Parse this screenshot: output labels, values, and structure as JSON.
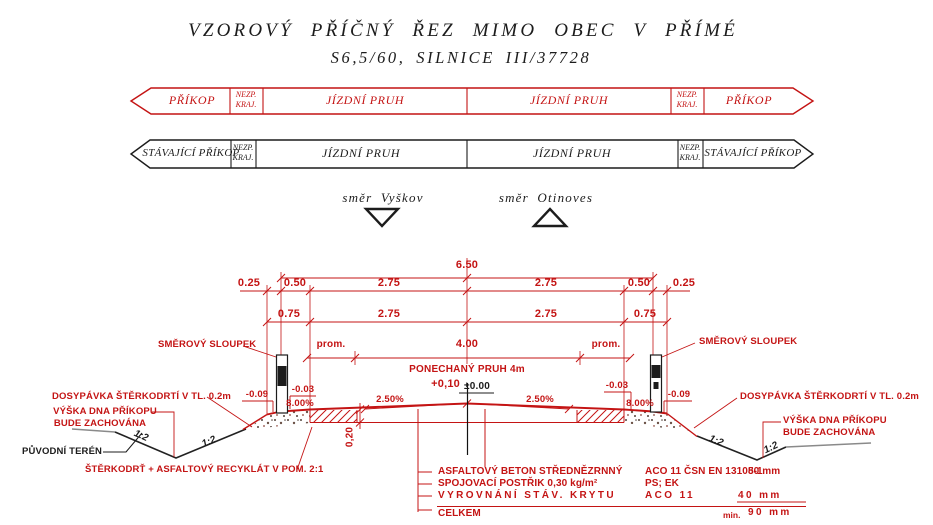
{
  "title": {
    "line1": "VZOROVÝ PŘÍČNÝ ŘEZ MIMO OBEC V PŘÍMÉ",
    "line2": "S6,5/60, SILNICE III/37728"
  },
  "band_proposed": {
    "ditch_left": "PŘÍKOP",
    "shoulder_top": "NEZP.",
    "shoulder_bottom": "KRAJ.",
    "lane_left": "JÍZDNÍ PRUH",
    "lane_right": "JÍZDNÍ PRUH",
    "ditch_right": "PŘÍKOP"
  },
  "band_existing": {
    "ditch_left": "STÁVAJÍCÍ PŘÍKOP",
    "shoulder_top": "NEZP.",
    "shoulder_bottom": "KRAJ.",
    "lane_left": "JÍZDNÍ PRUH",
    "lane_right": "JÍZDNÍ PRUH",
    "ditch_right": "STÁVAJÍCÍ PŘÍKOP"
  },
  "directions": {
    "left": "směr Vyškov",
    "right": "směr Otinoves"
  },
  "dims": {
    "total": "6.50",
    "row2": [
      "0.25",
      "0.50",
      "2.75",
      "2.75",
      "0.50",
      "0.25"
    ],
    "row3": [
      "0.75",
      "2.75",
      "2.75",
      "0.75"
    ],
    "row4": [
      "prom.",
      "4.00",
      "prom."
    ],
    "kept_lane": "PONECHANÝ PRUH 4m",
    "pavement_depth": "0,20"
  },
  "levels": {
    "new_center": "+0,10",
    "existing_center": "±0.00",
    "left_outer": "-0.09",
    "left_edge": "-0.03",
    "right_edge": "-0.03",
    "right_outer": "-0.09"
  },
  "slopes": {
    "cross_left": "2.50%",
    "cross_right": "2.50%",
    "shoulder_left": "8.00%",
    "shoulder_right": "8.00%",
    "embankment": "1:2"
  },
  "labels": {
    "guide_post": "SMĚROVÝ SLOUPEK",
    "gravel_backfill": "DOSYPÁVKA ŠTĚRKODRTÍ V TL. 0.2m",
    "ditch_line1": "VÝŠKA DNA PŘÍKOPU",
    "ditch_line2": "BUDE ZACHOVÁNA",
    "original_terrain": "PŮVODNÍ TERÉN",
    "recycled_fill": "ŠTĚRKODRŤ + ASFALTOVÝ RECYKLÁT V POM. 2:1"
  },
  "layers": {
    "rows": [
      {
        "name": "ASFALTOVÝ BETON STŘEDNĚZRNNÝ",
        "spec": "ACO 11 ČSN EN 13108-1",
        "thickness": "50 mm"
      },
      {
        "name": "SPOJOVACÍ POSTŘIK 0,30 kg/m²",
        "spec": "PS; EK",
        "thickness": ""
      },
      {
        "name": "VYROVNÁNÍ STÁV. KRYTU",
        "spec": "ACO 11",
        "thickness": "40 mm"
      }
    ],
    "total": {
      "label": "CELKEM",
      "prefix": "min.",
      "value": "90 mm"
    }
  },
  "colors": {
    "red": "#c41414",
    "black": "#1c1c1c",
    "gray": "#8a8a8a"
  }
}
